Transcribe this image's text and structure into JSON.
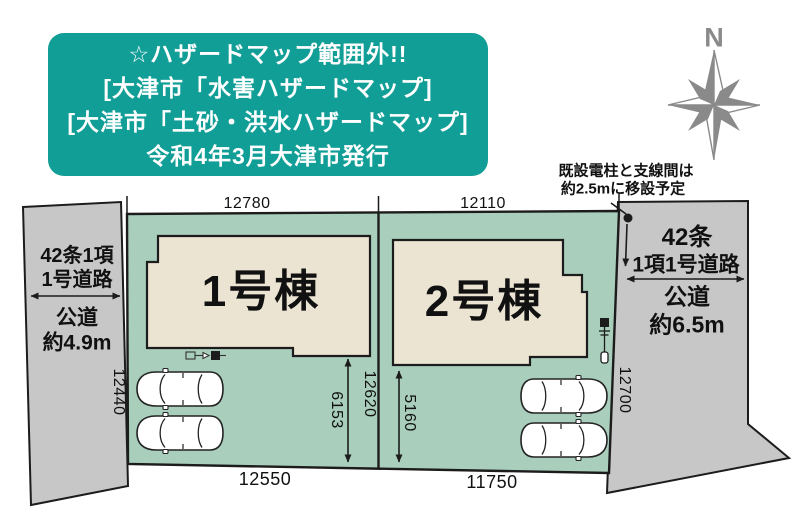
{
  "hazard_notice": {
    "lines": [
      "☆ハザードマップ範囲外!!",
      "[大津市「水害ハザードマップ]",
      "[大津市「土砂・洪水ハザードマップ]",
      "令和4年3月大津市発行"
    ]
  },
  "compass": {
    "label": "N"
  },
  "pole_note": {
    "line1": "既設電柱と支線間は",
    "line2": "約2.5mに移設予定"
  },
  "roads": {
    "left": {
      "law_line1": "42条1項",
      "law_line2": "1号道路",
      "type": "公道",
      "width": "約4.9m"
    },
    "right": {
      "law_line1": "42条",
      "law_line2": "1項1号道路",
      "type": "公道",
      "width": "約6.5m"
    }
  },
  "buildings": [
    {
      "label": "1号棟"
    },
    {
      "label": "2号棟"
    }
  ],
  "dimensions": {
    "plot1_top": "12780",
    "plot2_top": "12110",
    "plot1_bottom": "12550",
    "plot2_bottom": "11750",
    "left_frontage": "12440",
    "boundary_depth": "12620",
    "right_frontage": "12700",
    "plot1_yard_depth": "6153",
    "plot2_yard_depth": "5160"
  },
  "colors": {
    "notice_teal": "#119e96",
    "site_green": "#a9cfbc",
    "building_beige": "#ece4d3",
    "road_gray": "#c7c7c7",
    "compass_gray": "#8a8a8a",
    "line_black": "#1c1c1c"
  }
}
